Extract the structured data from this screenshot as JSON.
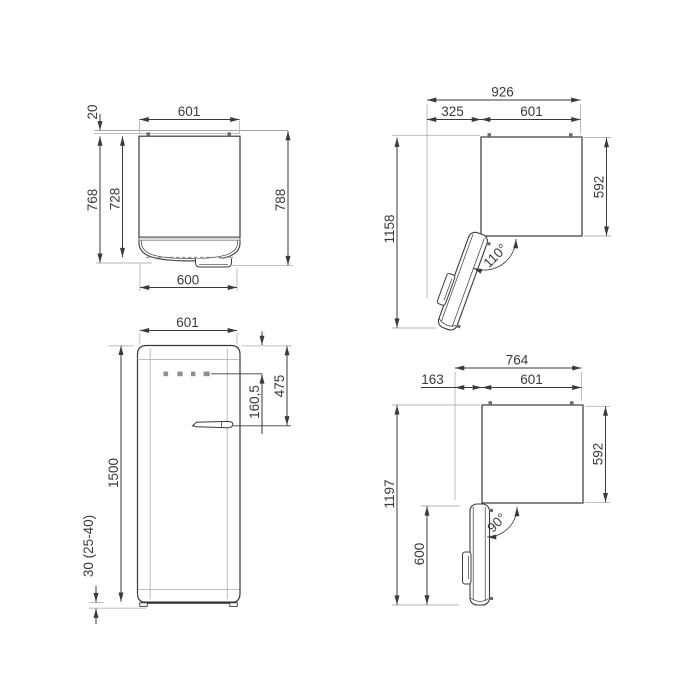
{
  "drawing": {
    "views": {
      "plan_door_closed": {
        "width_top": "601",
        "hinge_gap": "20",
        "depth_total": "768",
        "depth_body": "728",
        "depth_overall": "788",
        "door_width": "600"
      },
      "plan_door_open_110": {
        "overall_width": "926",
        "door_projection": "325",
        "cabinet_width": "601",
        "total_depth_door_open": "1158",
        "cabinet_depth": "592",
        "door_angle": "110°"
      },
      "front": {
        "cabinet_width": "601",
        "cabinet_height": "1500",
        "controls_offset": "160,5",
        "handle_offset": "475",
        "feet_height": "30 (25-40)"
      },
      "plan_door_open_90": {
        "overall_width": "764",
        "door_projection": "163",
        "cabinet_width": "601",
        "total_depth_door_open": "1197",
        "cabinet_depth": "592",
        "door_depth_open": "600",
        "door_angle": "90°"
      }
    }
  }
}
